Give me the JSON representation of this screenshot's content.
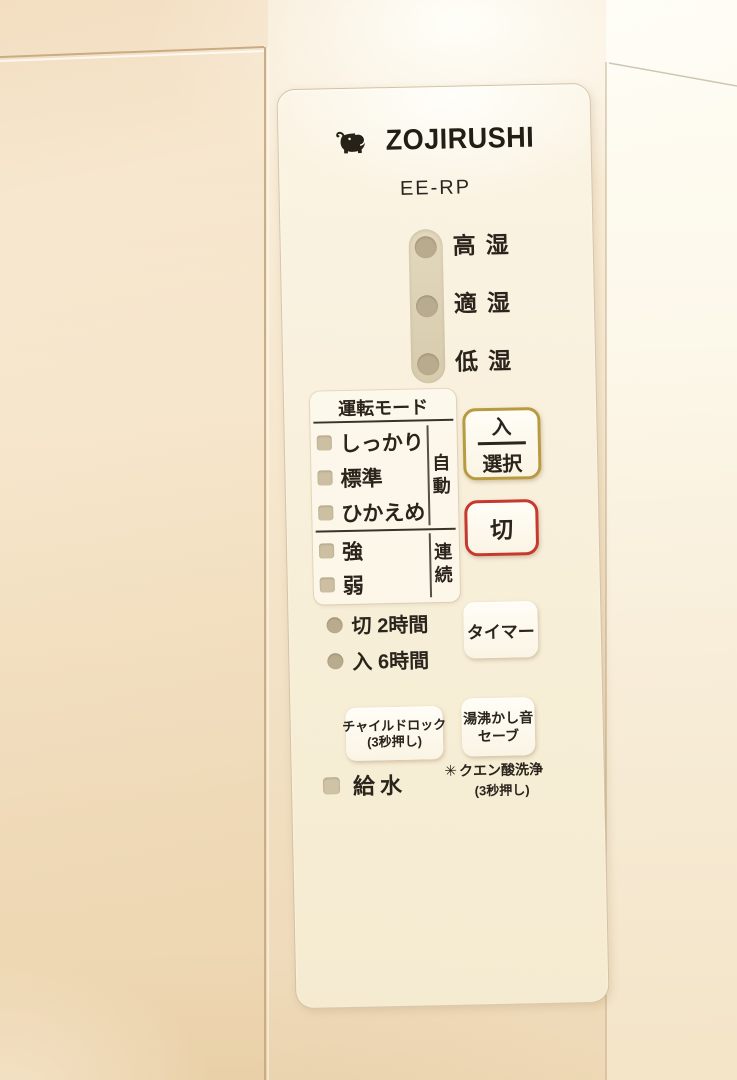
{
  "device": {
    "brand": "ZOJIRUSHI",
    "model": "EE-RP"
  },
  "humidity": {
    "levels": [
      {
        "label": "高湿"
      },
      {
        "label": "適湿"
      },
      {
        "label": "低湿"
      }
    ]
  },
  "mode": {
    "title": "運転モード",
    "auto_label": "自動",
    "continuous_label": "連続",
    "auto_modes": [
      {
        "label": "しっかり"
      },
      {
        "label": "標準"
      },
      {
        "label": "ひかえめ"
      }
    ],
    "continuous_modes": [
      {
        "label": "強"
      },
      {
        "label": "弱"
      }
    ]
  },
  "timer_leds": [
    {
      "label": "切 2時間"
    },
    {
      "label": "入 6時間"
    }
  ],
  "buttons": {
    "power_select": {
      "top": "入",
      "bottom": "選択"
    },
    "off": {
      "label": "切"
    },
    "timer": {
      "label": "タイマー"
    },
    "boil_sound_save": {
      "line1": "湯沸かし音",
      "line2": "セーブ"
    },
    "child_lock": {
      "line1": "チャイルドロック",
      "line2": "(3秒押し)"
    }
  },
  "misc": {
    "water_refill": "給水",
    "citric_icon": "✳",
    "citric_clean": "クエン酸洗浄",
    "citric_note": "(3秒押し)"
  },
  "colors": {
    "body_beige": "#f3e2c6",
    "panel_cream": "#f8f0dd",
    "text": "#2a241c",
    "led_unlit": "#c6b99c",
    "select_button_border": "#b89b41",
    "off_button_border": "#c5392f"
  }
}
